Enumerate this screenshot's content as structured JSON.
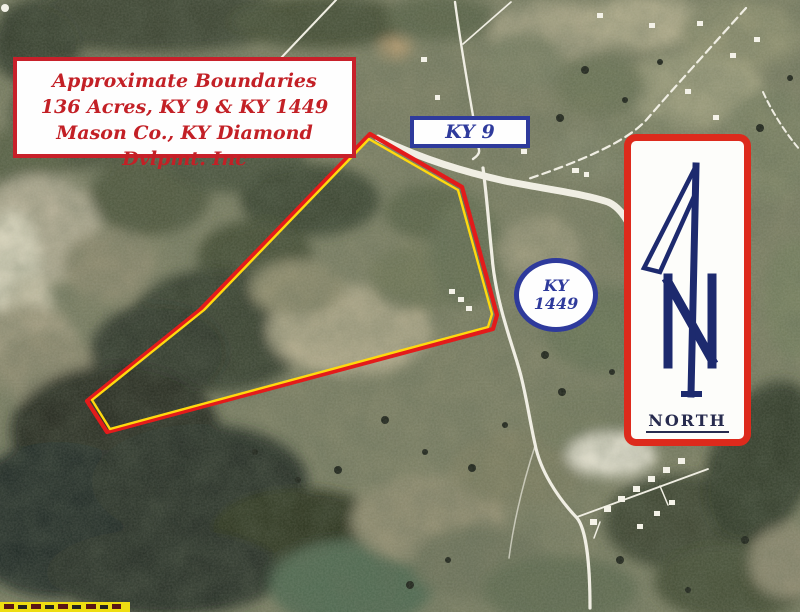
{
  "info_box": {
    "line1": "Approximate Boundaries",
    "line2": "136 Acres, KY 9 & KY 1449",
    "line3": "Mason Co., KY Diamond Dvlpmt. Inc"
  },
  "labels": {
    "ky9": "KY 9",
    "ky1449_top": "KY",
    "ky1449_bottom": "1449"
  },
  "north_indicator": {
    "label": "NORTH"
  },
  "boundary": {
    "outer_points": "370,134 462,187 497,315 493,329 107,432 87,401 200,310",
    "inner_points": "369,139 458,190 492,314 488,327 110,429 92,400 204,310"
  },
  "colors": {
    "annotation_red": "#c8202a",
    "annotation_blue": "#2e3a9c",
    "boundary_red": "#e31b1b",
    "boundary_yellow": "#ffd90f",
    "north_border_red": "#dd2a1c",
    "north_arrow_navy": "#1d2a6e",
    "watermark_yellow": "#eedd12"
  }
}
